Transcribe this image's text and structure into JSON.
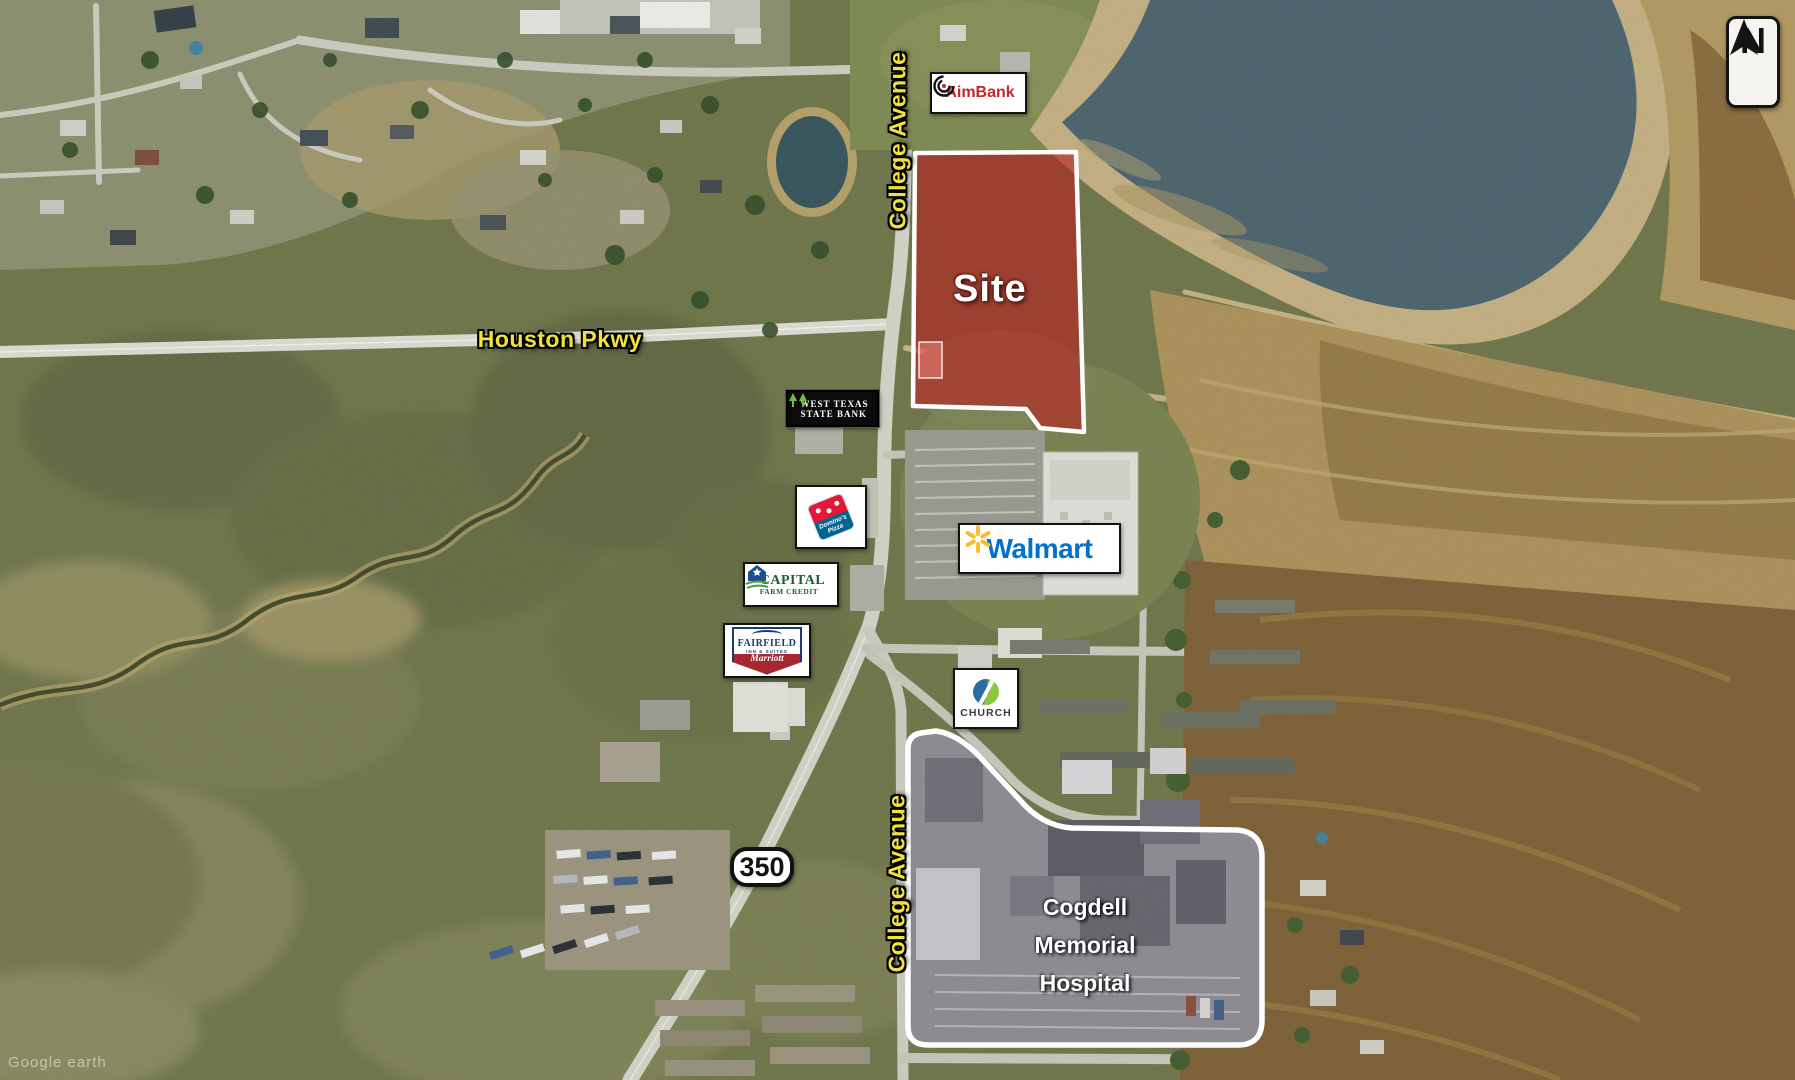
{
  "site": {
    "label": "Site"
  },
  "roads": {
    "college_avenue_north": "College Avenue",
    "college_avenue_south": "College Avenue",
    "houston_pkwy": "Houston Pkwy",
    "highway_350": "350"
  },
  "businesses": {
    "aimbank": {
      "name": "AimBank"
    },
    "west_texas_state_bank": {
      "line1": "WEST TEXAS",
      "line2": "STATE BANK"
    },
    "dominos": {
      "line1": "Domino's",
      "line2": "Pizza"
    },
    "capital_farm_credit": {
      "line1": "CAPITAL",
      "line2": "FARM CREDIT"
    },
    "fairfield": {
      "line1": "FAIRFIELD",
      "line2": "INN & SUITES",
      "line3": "Marriott"
    },
    "walmart": {
      "name": "Walmart"
    },
    "church": {
      "name": "CHURCH"
    }
  },
  "hospital": {
    "line1": "Cogdell",
    "line2": "Memorial",
    "line3": "Hospital"
  },
  "compass": {
    "label": "N"
  },
  "watermark": {
    "text": "Google earth"
  },
  "colors": {
    "site_fill": "#b91c1c",
    "site_outline": "#ffffff",
    "road_label_yellow": "#f2e13c",
    "walmart_blue": "#0071ce",
    "walmart_spark": "#fdbb30",
    "aimbank_red": "#c1272d",
    "dominos_red": "#e31837",
    "dominos_blue": "#006491",
    "capital_green": "#1e5c38",
    "fairfield_navy": "#1d3c6e",
    "marriott_red": "#a6272f",
    "church_blue": "#2b6ca3",
    "church_green": "#8dc63f",
    "tree_green": "#6abf4b"
  }
}
